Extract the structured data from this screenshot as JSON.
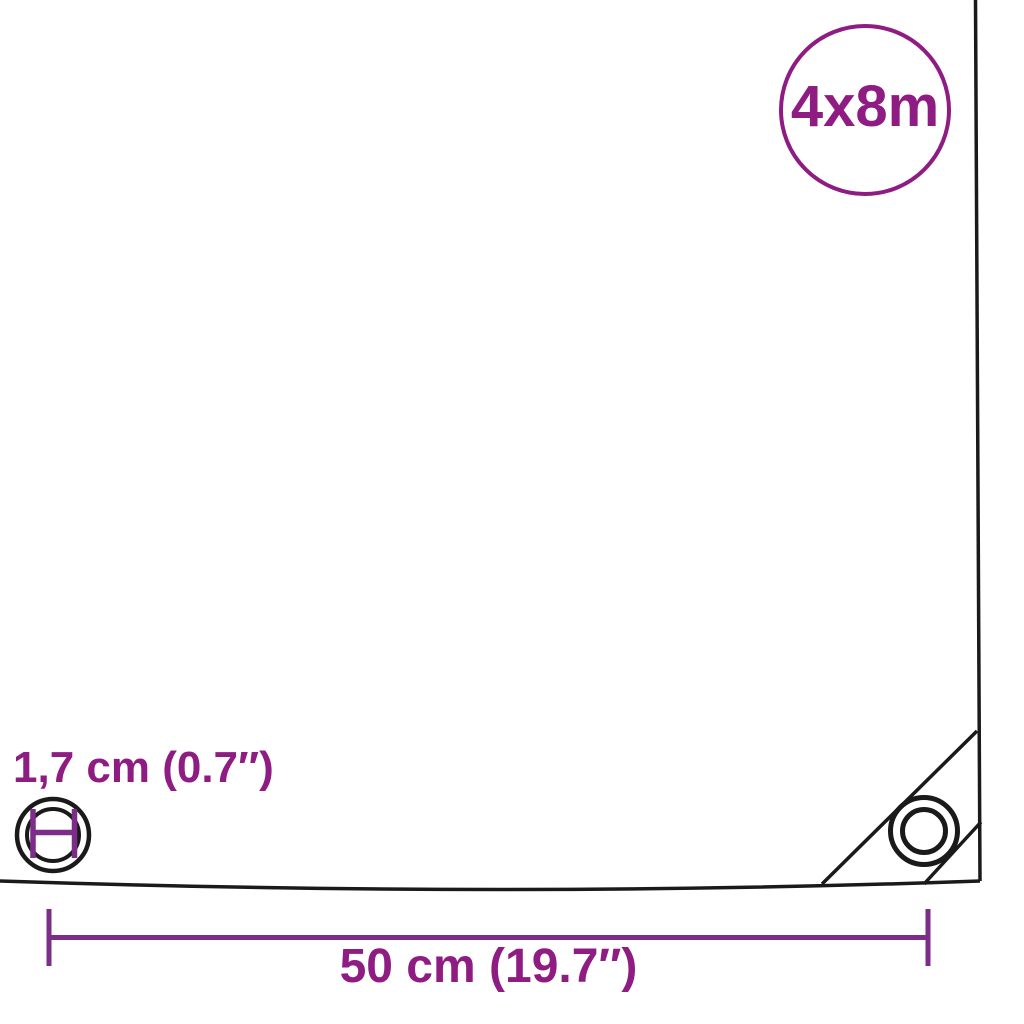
{
  "size_badge": {
    "label": "4x8m"
  },
  "eyelet": {
    "diameter_label": "1,7 cm (0.7″)"
  },
  "edge_distance": {
    "label": "50 cm (19.7″)"
  },
  "colors": {
    "accent_purple": "#8E1C82",
    "measure_purple": "#7C2D87",
    "outline_black": "#1A1A1A",
    "background": "#FFFFFF"
  },
  "icons": {
    "size_badge_circle": "purple-outline-circle",
    "eyelet_diameter_icon": "concentric-circles-with-H-diameter-marker",
    "corner_grommet_icon": "concentric-circles",
    "dimension_line": "horizontal-line-with-end-ticks"
  }
}
